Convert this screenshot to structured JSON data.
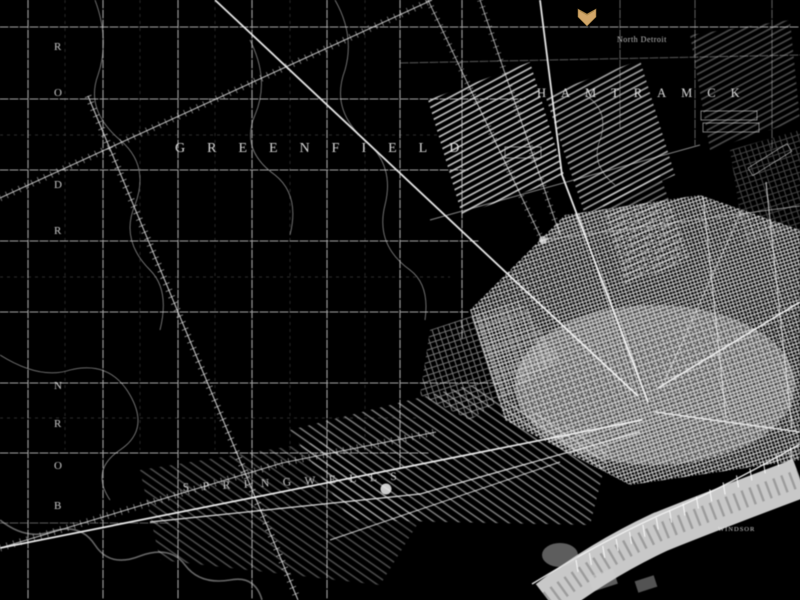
{
  "image_kind": "inverted vintage street map (white linework on black), Detroit area",
  "colors": {
    "background": "#000000",
    "linework": "#e8e8e8",
    "river": "#d9d9d9",
    "marker_gold": "#d2a769"
  },
  "labels": {
    "township_center": "GREENFIELD",
    "township_top_right": "HAMTRAMCK",
    "township_bottom": "SPRINGWELLS",
    "settlement_small": "North Detroit",
    "river_bank_town": "WINDSOR"
  },
  "left_edge_letters": [
    {
      "ch": "R"
    },
    {
      "ch": "O"
    },
    {
      "ch": "D"
    },
    {
      "ch": "R"
    },
    {
      "ch": "N"
    },
    {
      "ch": "R"
    },
    {
      "ch": "O"
    },
    {
      "ch": "B"
    }
  ],
  "marker": {
    "type": "gold-chevron",
    "color": "#d2a769"
  }
}
